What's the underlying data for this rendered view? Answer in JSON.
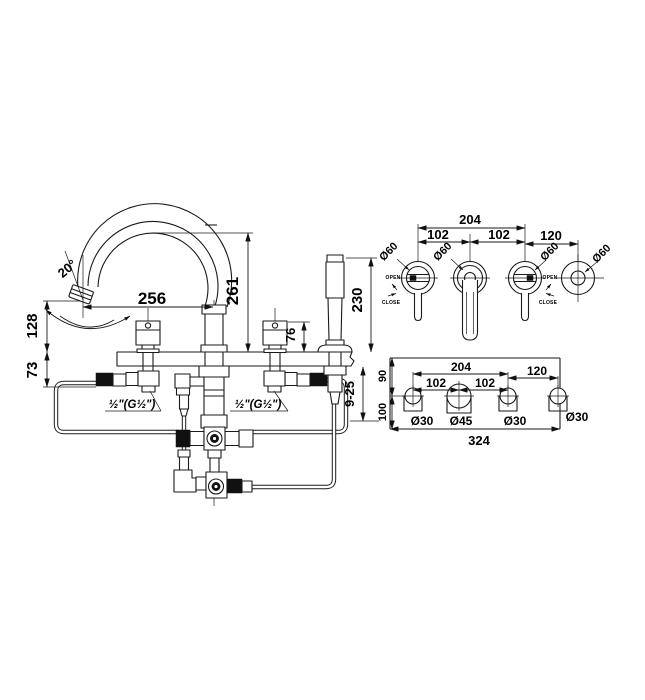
{
  "front": {
    "angle": "20°",
    "reach": "256",
    "height": "261",
    "outlet_height": "128",
    "under_deck": "73",
    "handle_height": "76",
    "shower_height": "230",
    "deck_range": "9-25",
    "left_connection": "½\"(G½\")",
    "right_connection": "½\"(G½\")"
  },
  "top": {
    "span": "204",
    "pitch_left": "102",
    "pitch_right": "102",
    "offset": "120",
    "dia": "Ø60",
    "open": "OPEN",
    "close": "CLOSE"
  },
  "plan": {
    "span": "204",
    "pitch_left": "102",
    "pitch_right": "102",
    "offset": "120",
    "rear": "90",
    "front": "100",
    "total": "324",
    "holes": [
      "Ø30",
      "Ø45",
      "Ø30",
      "Ø30"
    ]
  }
}
